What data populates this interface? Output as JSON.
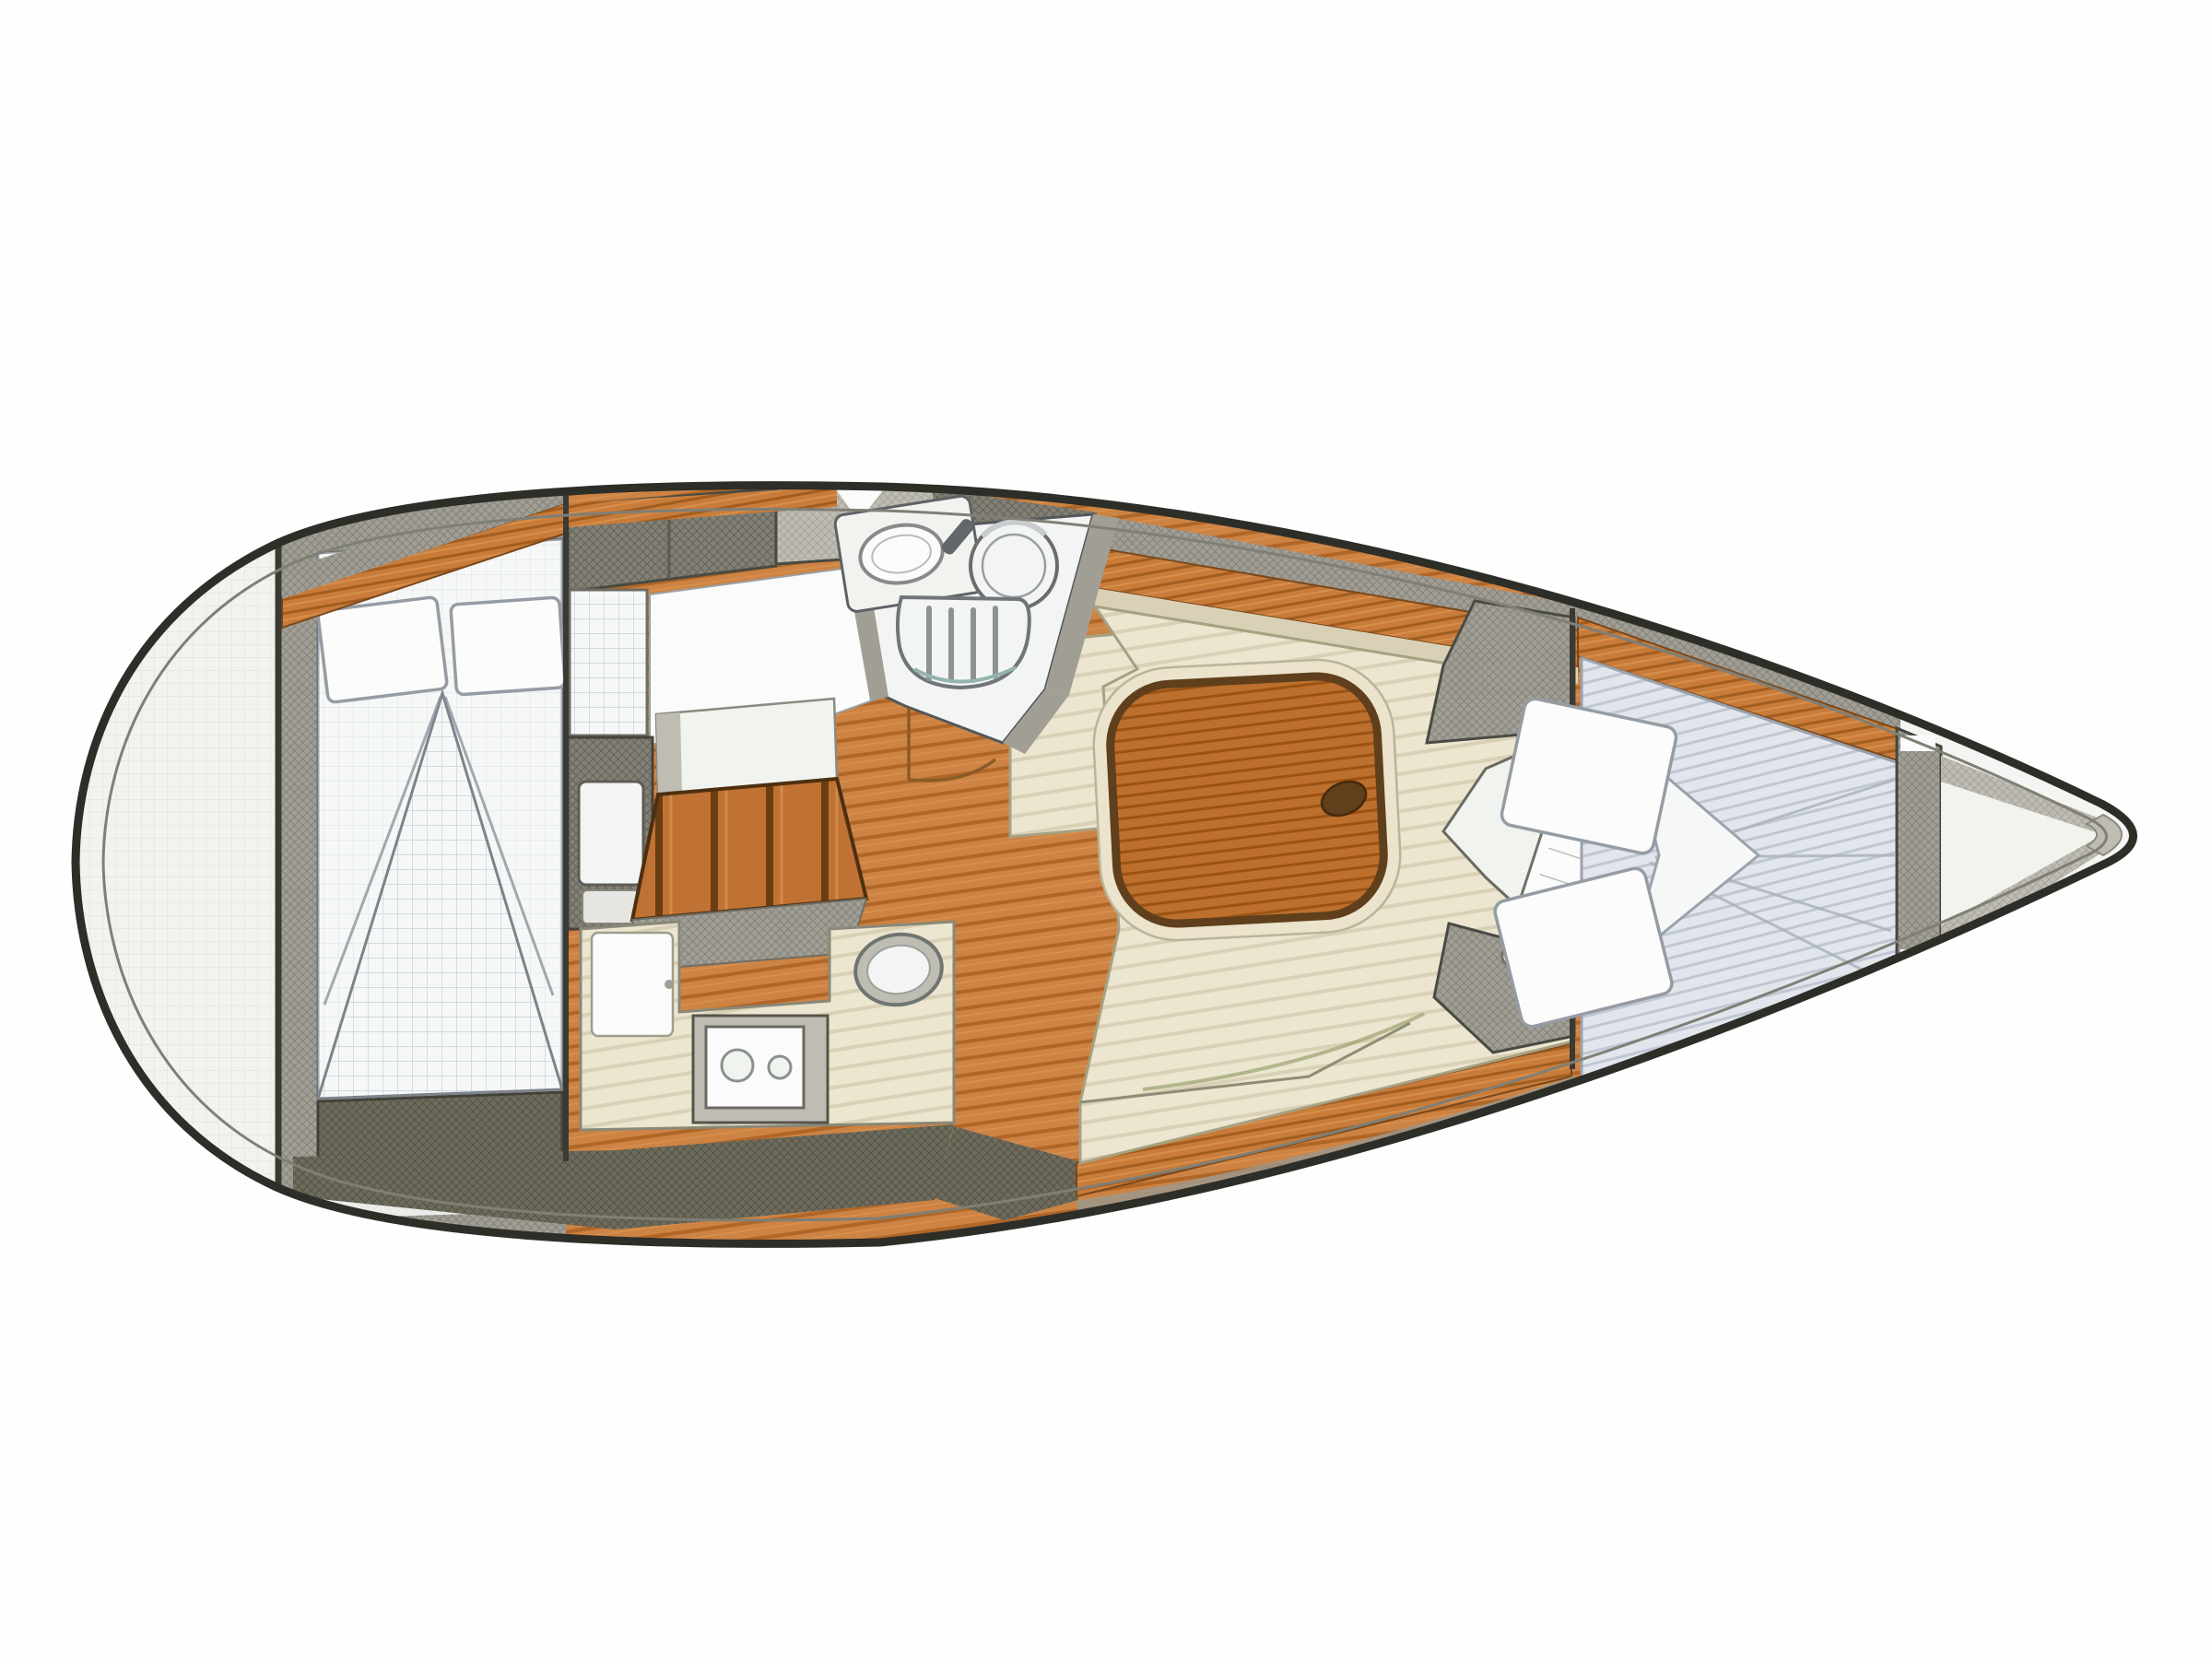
{
  "figure": {
    "kind": "sailboat-interior-floor-plan",
    "orientation": "bow-right",
    "rooms": [
      "stern-lazarette",
      "aft-cabin",
      "companionway",
      "galley",
      "head",
      "salon",
      "v-berth",
      "bow-locker"
    ]
  },
  "colors": {
    "background": "#fdfefd",
    "paper": "#f1f3ef",
    "hull_fill": "#f4f5f2",
    "hull_outline": "#2e2e29",
    "hull_inner": "#7f7f76",
    "grey_dark": "#838176",
    "grey_dark_line": "#69675d",
    "grey_mid": "#a19f95",
    "grey_mid_line": "#88867c",
    "grey_light": "#bfbdb3",
    "grey_light_line": "#a8a69c",
    "olive_dark": "#6e6c5d",
    "olive_dark_line": "#585648",
    "wood": "#c97c3a",
    "wood_line": "#a15d20",
    "wood_light": "#e09a58",
    "wood_edge": "#7a481c",
    "floor": "#cd8343",
    "floor_line": "#af6627",
    "table_wood": "#bd6f2d",
    "table_line": "#9a5315",
    "table_edge": "#5f3f1c",
    "table_ring": "#ebe3cb",
    "steps_wood": "#bf7233",
    "steps_gap": "#6a3d12",
    "cushion": "#ece5cf",
    "cushion_line": "#d9d1b6",
    "cushion_edge": "#a6a182",
    "cushion_shadow": "#9aa36f",
    "bed_white": "#f6f8f7",
    "bed_grid": "#c7d0d8",
    "bed_edge": "#6e737a",
    "pillow": "#fbfcfb",
    "pillow_edge": "#959ca4",
    "mattress": "#e2e6ec",
    "mattress_line": "#bfc8d2",
    "fixture_white": "#f3f5f4",
    "fixture_edge": "#63666a",
    "fixture_mid": "#9b9ea0",
    "teal": "#93b5ae",
    "stern_grid_line": "#dfe3dd",
    "door_wood": "#8a5a28",
    "white": "#fafbfa"
  }
}
